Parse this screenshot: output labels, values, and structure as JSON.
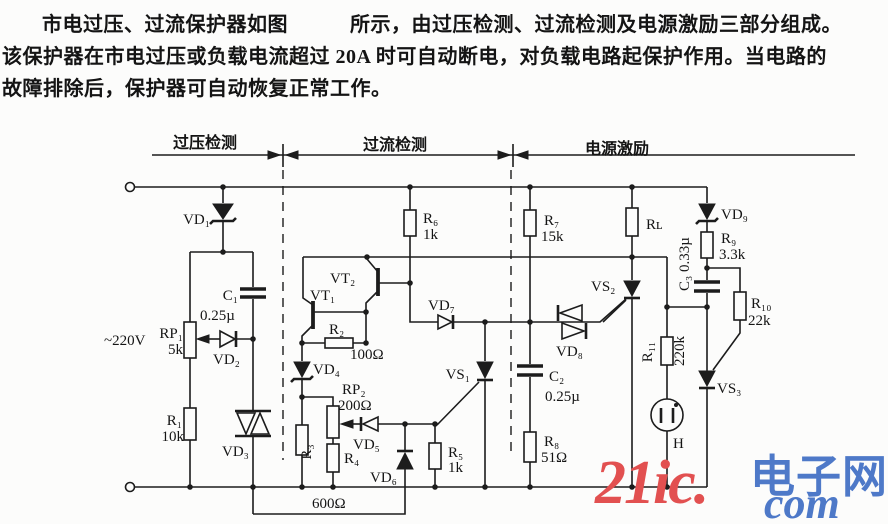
{
  "intro": {
    "line1a": "市电过压、过流保护器如图",
    "line1b": "所示，由过压检测、过流检测及电源激励三部分组成。",
    "line2": "该保护器在市电过压或负载电流超过 20A 时可自动断电，对负载电路起保护作用。当电路的",
    "line3": "故障排除后，保护器可自动恢复正常工作。"
  },
  "sections": {
    "overvoltage": "过压检测",
    "overcurrent": "过流检测",
    "excitation": "电源激励"
  },
  "components": {
    "supply": "~220V",
    "vd1": "VD₁",
    "c1": "C₁",
    "c1_val": "0.25µ",
    "rp1": "RP₁",
    "rp1_val": "5k",
    "vd2": "VD₂",
    "r1": "R₁",
    "r1_val": "10k",
    "vd3": "VD₃",
    "r6": "R₆",
    "r6_val": "1k",
    "vt1": "VT₁",
    "vt2": "VT₂",
    "r2": "R₂",
    "r2_val": "100Ω",
    "vd4": "VD₄",
    "rp2": "RP₂",
    "rp2_val": "200Ω",
    "r3": "R₃",
    "r4": "R₄",
    "vd5": "VD₅",
    "vd6": "VD₆",
    "r5": "R₅",
    "r5_val": "1k",
    "vs1": "VS₁",
    "shunt": "600Ω",
    "vd7": "VD₇",
    "r7": "R₇",
    "r7_val": "15k",
    "c2": "C₂",
    "c2_val": "0.25µ",
    "r8": "R₈",
    "r8_val": "51Ω",
    "vd8": "VD₈",
    "vs2": "VS₂",
    "rl": "Rʟ",
    "r11": "R₁₁",
    "r11_val": "220k",
    "lamp": "H",
    "vs3": "VS₃",
    "vd9": "VD₉",
    "r9": "R₉",
    "r9_val": "3.3k",
    "c3": "C₃ 0.33µ",
    "r10": "R₁₀",
    "r10_val": "22k"
  },
  "watermark": {
    "brand": "21ic.",
    "site_cn": "电子网",
    "tld": "com",
    "red": "#e25050",
    "blue": "#4e79c8"
  }
}
